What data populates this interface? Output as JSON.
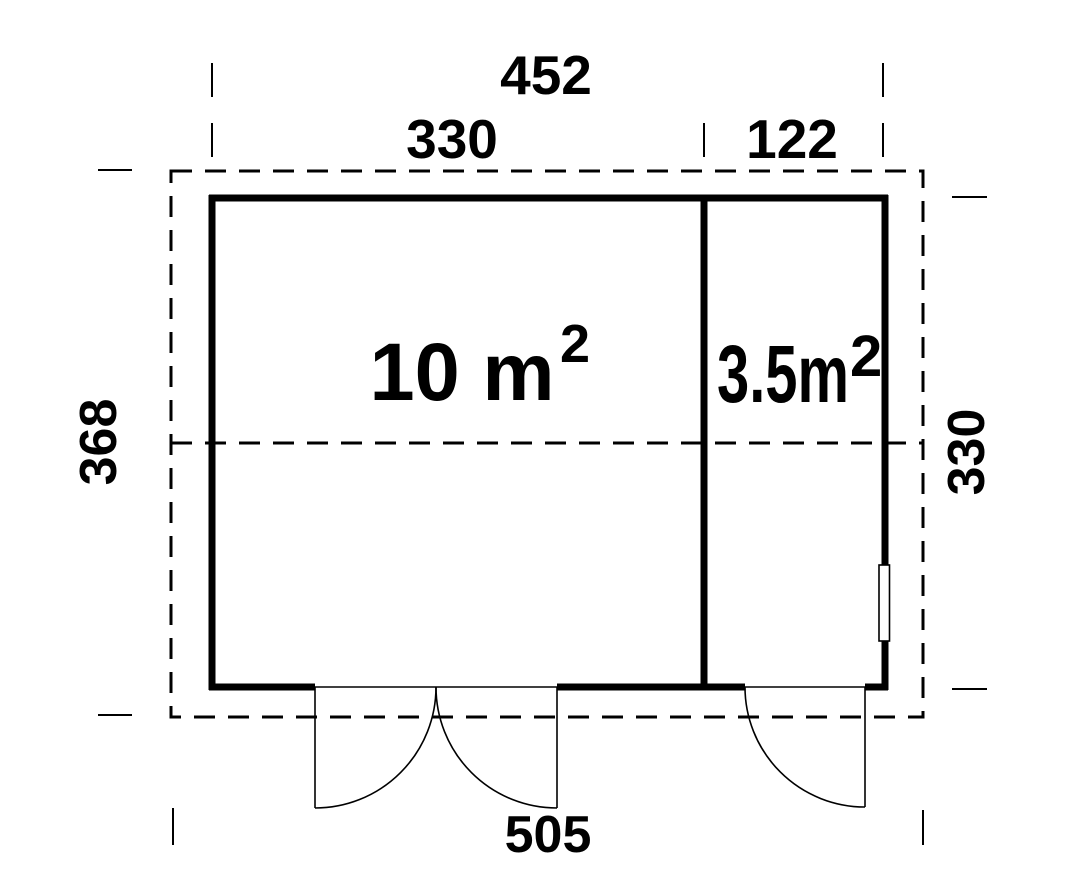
{
  "plan": {
    "colors": {
      "line": "#000000",
      "background": "#ffffff"
    },
    "dimensions": {
      "top_overall": "452",
      "top_left_room": "330",
      "top_right_room": "122",
      "left_overall": "368",
      "right_wall": "330",
      "bottom_overall": "505"
    },
    "rooms": [
      {
        "area": "10 m",
        "exponent": "2"
      },
      {
        "area": "3.5m",
        "exponent": "2"
      }
    ]
  }
}
